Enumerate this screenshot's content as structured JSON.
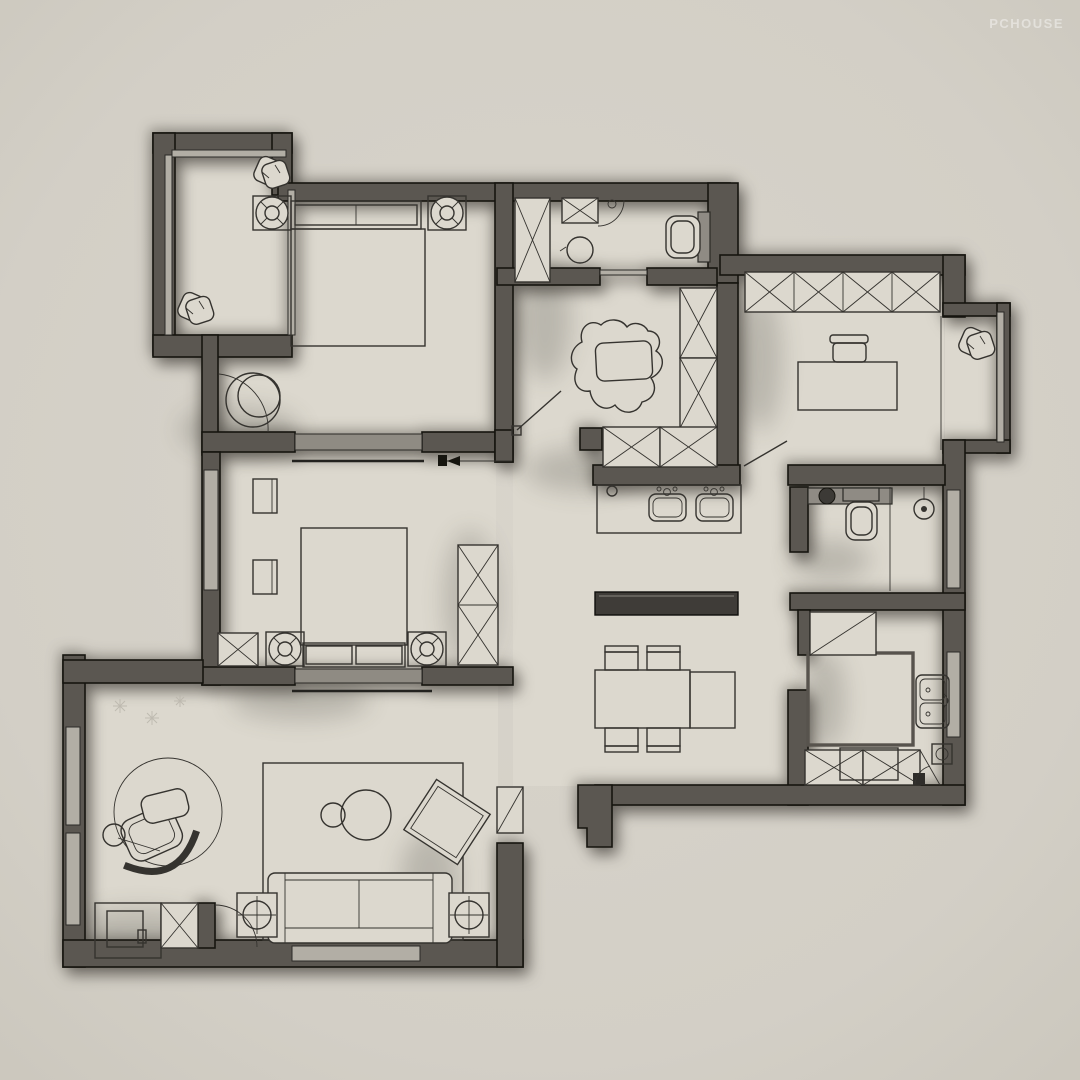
{
  "watermark": {
    "text": "PCHOUSE"
  },
  "palette": {
    "background": "#d3cfc6",
    "floor": "#dcd8ce",
    "wall": "#5b5751",
    "wall_outline": "#16150f",
    "furniture_line": "#35332f",
    "window_band": "#b2aea5",
    "interior_window_band": "#8f8b83",
    "dark_furniture": "#3f3c38",
    "watermark_color": "rgba(255,255,255,0.42)"
  },
  "floorplan": {
    "type": "apartment-floor-plan-top-view",
    "rooms": [
      {
        "id": "balcony-top-left",
        "features": [
          "window-walls",
          "plant",
          "plant"
        ]
      },
      {
        "id": "master-bedroom",
        "features": [
          "double-bed",
          "headboard-pillows",
          "nightstand-left",
          "nightstand-right",
          "ceiling-lamp-left",
          "ceiling-lamp-right",
          "round-chair",
          "balcony-door-arc",
          "door-leaf",
          "window-band"
        ]
      },
      {
        "id": "main-bathroom",
        "features": [
          "tall-cabinet-x",
          "wall-cabinet-x",
          "shower-door-arc",
          "washbasin",
          "toilet",
          "sliding-door"
        ]
      },
      {
        "id": "hallway",
        "features": [
          "cloud-rug",
          "closet-two-x",
          "shoe-cabinet-row-x"
        ]
      },
      {
        "id": "study",
        "features": [
          "wardrobe-four-x",
          "desk",
          "chair",
          "curtain-line",
          "door-leaf"
        ]
      },
      {
        "id": "study-bay-window",
        "features": [
          "window-frame",
          "plant"
        ]
      },
      {
        "id": "second-bedroom",
        "features": [
          "double-bed",
          "headboard-pillows",
          "nightstand-left",
          "nightstand-right",
          "ceiling-lamp-left",
          "ceiling-lamp-right",
          "wardrobe-two-x",
          "corner-cabinet-x",
          "wall-shelf",
          "wall-shelf",
          "sliding-door-arrow",
          "window-band"
        ]
      },
      {
        "id": "vanity-area",
        "features": [
          "counter",
          "basin-left",
          "basin-right"
        ]
      },
      {
        "id": "second-bathroom",
        "features": [
          "vanity-counter",
          "round-basin",
          "toilet",
          "shower-head",
          "glass-partition",
          "window"
        ]
      },
      {
        "id": "kitchen",
        "features": [
          "fridge",
          "u-counter",
          "double-sink",
          "cooktop",
          "cabinet-x-row",
          "appliance-circle",
          "window"
        ]
      },
      {
        "id": "dining-area",
        "features": [
          "sideboard",
          "dining-table",
          "table-extension",
          "chair",
          "chair",
          "chair",
          "chair"
        ]
      },
      {
        "id": "living-room",
        "features": [
          "area-rug",
          "sofa",
          "side-table-lamp-left",
          "side-table-lamp-right",
          "coffee-table-large",
          "coffee-table-small",
          "accent-chair-tilted",
          "floor-unit",
          "round-rug",
          "lounge-chair",
          "ottoman",
          "floor-lamp",
          "snowflake-decals",
          "shoe-cabinet",
          "storage-cabinet-x",
          "entry-door-arc",
          "windows"
        ]
      }
    ]
  }
}
